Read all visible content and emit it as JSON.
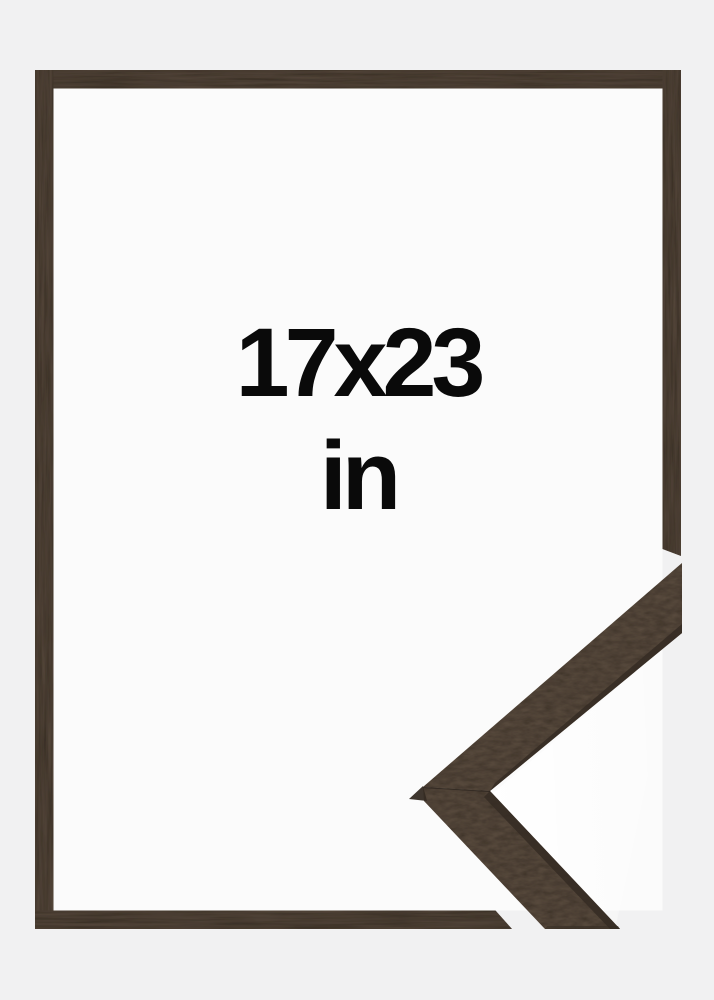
{
  "size_label": {
    "dimensions": "17x23",
    "unit": "in"
  },
  "colors": {
    "page_background": "#f1f1f2",
    "frame_interior": "#fbfbfb",
    "wood_base": "#54473a",
    "wood_arm": "#5b4d3f",
    "wood_dark_edge": "#352b23",
    "label_text": "#0a0a0a"
  }
}
